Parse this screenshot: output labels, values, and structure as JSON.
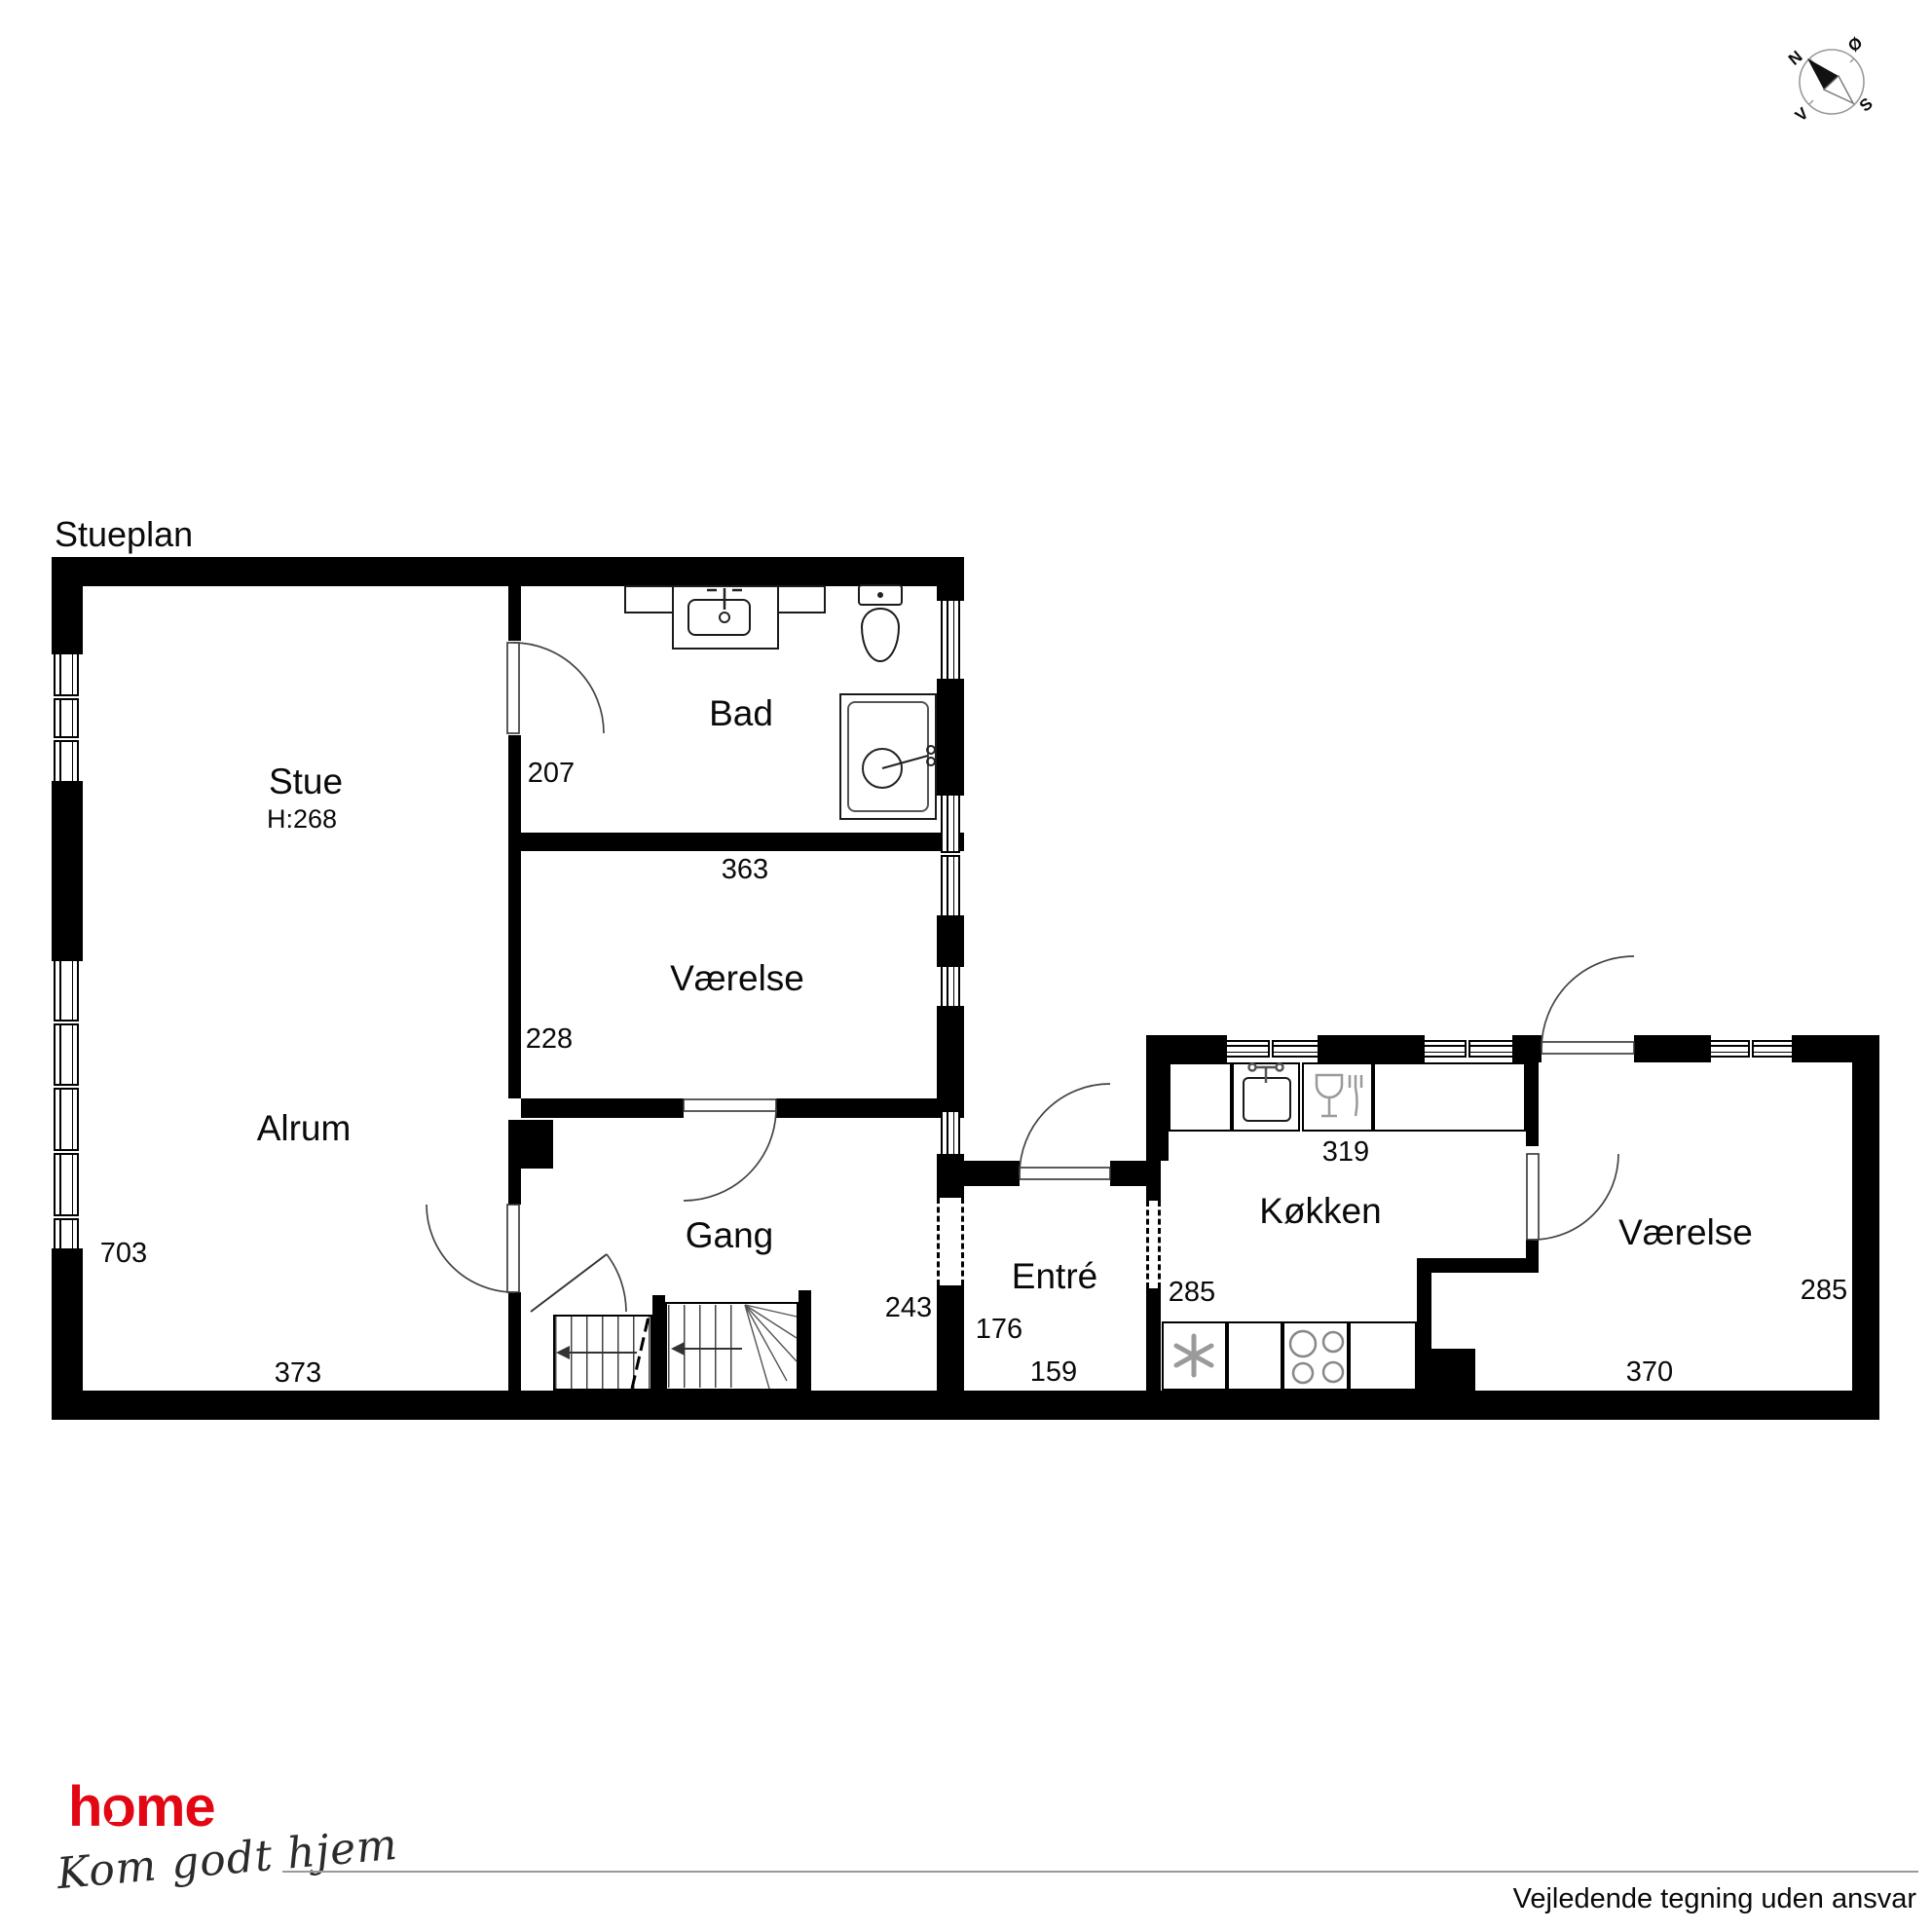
{
  "page": {
    "title": "Stueplan",
    "footer_disclaimer": "Vejledende tegning uden ansvar"
  },
  "logo": {
    "brand": "home",
    "tagline": "Kom godt hjem",
    "brand_color": "#e30613"
  },
  "compass": {
    "north": "N",
    "east": "Ø",
    "south": "S",
    "west": "V"
  },
  "rooms": {
    "stue": {
      "name": "Stue",
      "height_label": "H:268"
    },
    "alrum": {
      "name": "Alrum"
    },
    "bad": {
      "name": "Bad"
    },
    "vaerelse_left": {
      "name": "Værelse"
    },
    "gang": {
      "name": "Gang"
    },
    "entre": {
      "name": "Entré"
    },
    "koekken": {
      "name": "Køkken"
    },
    "vaerelse_right": {
      "name": "Værelse"
    }
  },
  "dimensions_cm": {
    "bad_left": "207",
    "bad_width": "363",
    "vaerelse_left_height": "228",
    "alrum_left": "703",
    "alrum_bottom": "373",
    "gang_right": "243",
    "entre_left": "176",
    "entre_bottom": "159",
    "entre_koekken": "285",
    "koekken_top": "319",
    "vaerelse_right_side": "285",
    "vaerelse_right_bottom": "370"
  },
  "colors": {
    "wall": "#000000"
  }
}
